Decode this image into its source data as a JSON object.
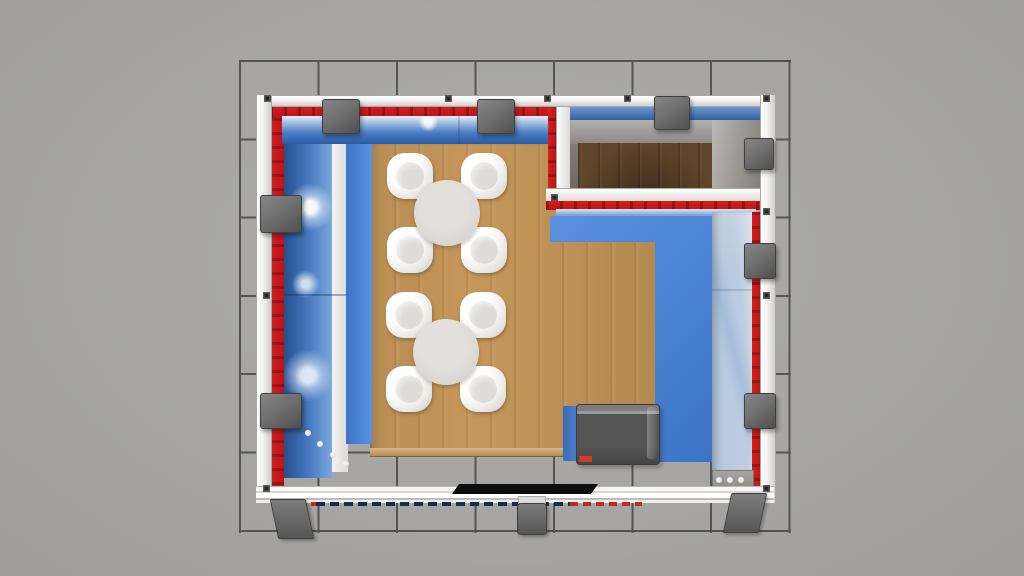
{
  "scene": {
    "title": "Top-down 3D render of an exhibition booth",
    "view": "top-down plan render",
    "environment": {
      "hall_floor": "grey exhibition floor with dark square grid",
      "grid_columns": 7,
      "grid_rows": 6
    },
    "booth": {
      "frame": "white aluminium extrusion frame, open front edge with base beam",
      "walls": "blue water-splash graphic panels with red trim band",
      "floor": "light oak raised platform",
      "platform_strip": "blue L-shaped floor strip along back-right and right side",
      "storage_room": "closed room in top-right corner with dark wood floor and grey inner walls",
      "furniture": {
        "table_sets": 2,
        "chairs_per_table": 4,
        "table_type": "round table, light grey top",
        "chair_type": "white tub chair",
        "counter": "dark grey counter with blue side panel and red base accent"
      },
      "fixtures": {
        "spotlights_top_wall": 3,
        "spotlights_left_wall": 2,
        "spotlights_right_wall": 3,
        "support_feet_front": 3,
        "front_mat": "black rectangular mat on base beam",
        "edge_dashes": "navy and red dashed graphic strip on base beam"
      }
    },
    "colors": {
      "hall_floor": "#a7a6a4",
      "grid_line": "#3a3a3a",
      "frame_white": "#f4f4f2",
      "frame_edge": "#a9a8a6",
      "wall_red": "#d6201c",
      "graphic_blue": "#4a7cc2",
      "graphic_blue_dark": "#24508f",
      "graphic_foam": "#e8eff7",
      "platform_blue": "#4d86d8",
      "wood": "#c49659",
      "wood_edge": "#d9b987",
      "storage_wood": "#5f452a",
      "panel_white": "#ecebe9",
      "table_top": "#d8d5d1",
      "chair_white": "#f4f3f1",
      "counter_gray": "#545454",
      "counter_blue": "#4c82d4",
      "accent_red": "#cf3a2c",
      "fixture_gray": "#707070",
      "mat_black": "#0d0d0d",
      "dash_navy": "#1b2a4a"
    }
  }
}
